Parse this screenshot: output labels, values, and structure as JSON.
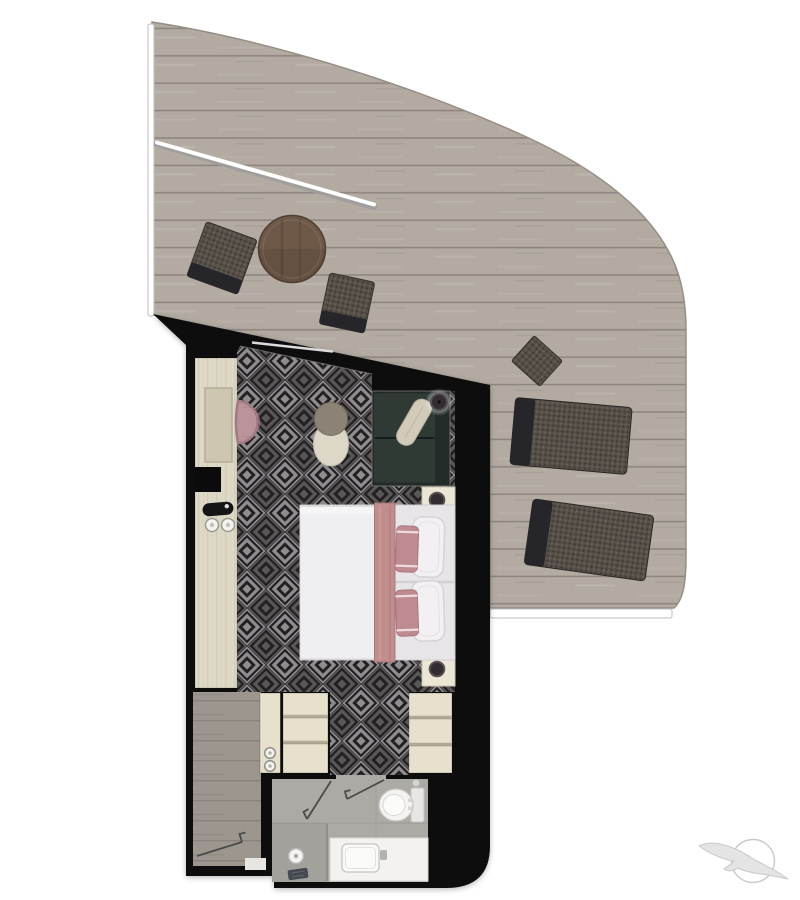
{
  "scene": {
    "type": "stateroom-floor-plan-top-view",
    "areas": [
      "balcony-deck",
      "stateroom",
      "entry-hall",
      "wardrobe",
      "bathroom"
    ],
    "furniture": [
      "deck-chair",
      "round-deck-table",
      "side-table",
      "sun-lounger",
      "desk-vanity",
      "desk-chair",
      "ottoman",
      "sofa",
      "corner-lamp",
      "nightstand",
      "double-bed",
      "wardrobe-shelves",
      "toilet",
      "vanity-sink",
      "shower"
    ],
    "logo": "seabird-over-sun"
  },
  "colors": {
    "background": "#ffffff",
    "wall": "#0b0b0b",
    "deck_wood": "#b3aba2",
    "deck_plank_line": "#6b645b",
    "deck_edge": "#968e84",
    "railing": "#ffffff",
    "railing_edge": "#bcbcbc",
    "carpet_base": "#242022",
    "carpet_motif": "#908d90",
    "desk": "#ded9c6",
    "desk_panel": "#cdc7b2",
    "desk_grain": "#b3ab92",
    "tray": "#151515",
    "chair_pink": "#bb939b",
    "chair_pink_edge": "#a07a84",
    "ottoman_body": "#dcd7c7",
    "ottoman_top": "#8c8377",
    "sofa": "#222b27",
    "sofa_cushion": "#2f3a35",
    "sofa_pillow": "#d2cbb9",
    "lamp": "#332d32",
    "lamp_rim": "#564f55",
    "nightstand": "#ece6d4",
    "bed_sheet": "#e7e5e7",
    "bed_duvet": "#efeef0",
    "bed_runner": "#c18d8d",
    "pillow_white": "#f2f0f2",
    "pillow_pink": "#bf8b91",
    "pillow_trim": "#ecdcde",
    "hall_wood": "#9c968e",
    "hall_plank_line": "#6f6860",
    "threshold": "#e8e6e2",
    "wardrobe": "#e6e0cd",
    "wardrobe_line": "#b2aa92",
    "bath_floor": "#abaaa5",
    "fixture": "#f4f3f1",
    "fixture_dim": "#e7e6e2",
    "fixture_edge": "#c6c4c0",
    "counter": "#f3f2ef",
    "faucet": "#b4b2ae",
    "glass": "#8b8984",
    "glass_door": "#dcdcdc",
    "door_line": "#4b4b4b",
    "drain": "#454a52",
    "lounge_dark": "#554f47",
    "lounge_band": "#26262a",
    "table_brown": "#6e5848",
    "table_brown_edge": "#513f31",
    "logo_fill": "#e4e4e4",
    "logo_edge": "#c9c9c9"
  }
}
